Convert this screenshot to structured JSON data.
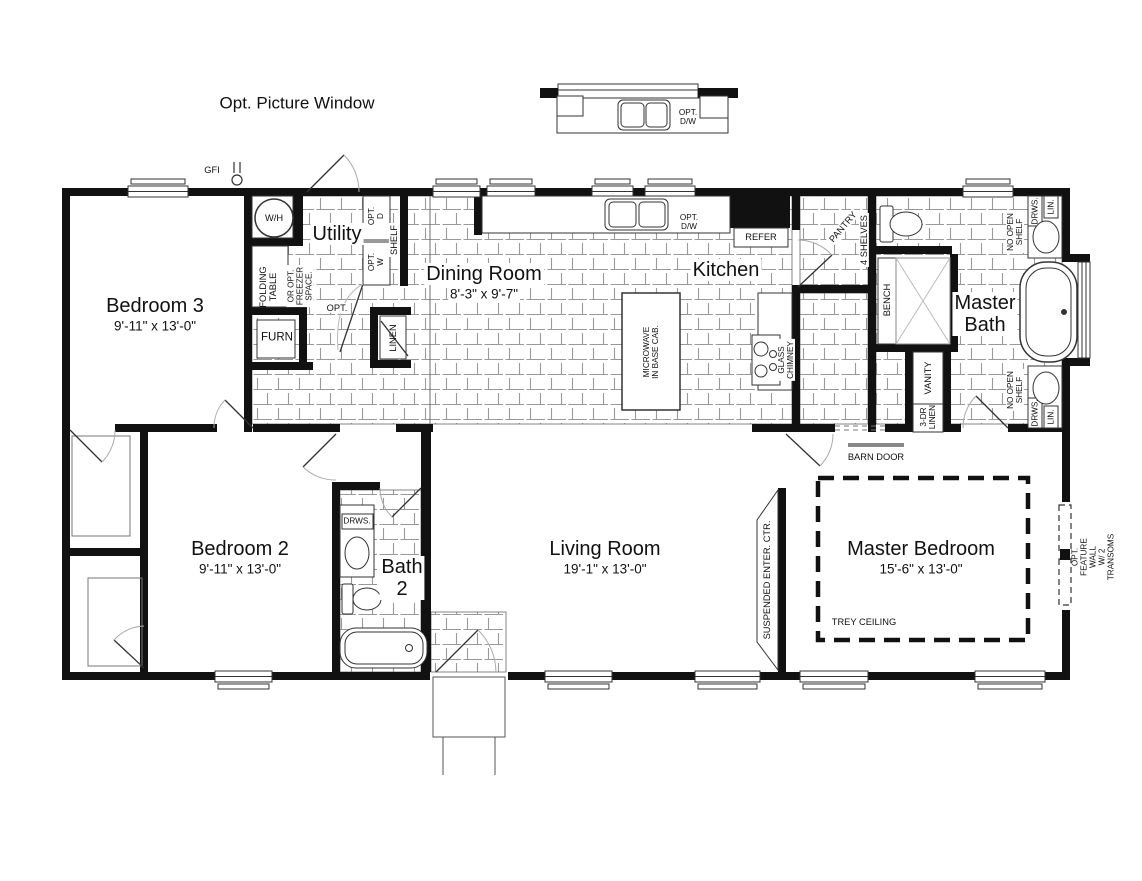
{
  "annotations": {
    "opt_picture_window": "Opt. Picture Window",
    "gfi": "GFI",
    "opt": "OPT.",
    "barn_door": "BARN DOOR",
    "trey_ceiling": "TREY CEILING",
    "suspended_enter_ctr": "SUSPENDED ENTER. CTR.",
    "opt_feature_wall": "OPT. FEATURE WALL\nW/ 2 TRANSOMS"
  },
  "rooms": {
    "bedroom3": {
      "name": "Bedroom 3",
      "dims": "9'-11\" x 13'-0\""
    },
    "utility": {
      "name": "Utility"
    },
    "dining_room": {
      "name": "Dining Room",
      "dims": "8'-3\" x 9'-7\""
    },
    "kitchen": {
      "name": "Kitchen"
    },
    "master_bath": {
      "name": "Master\nBath"
    },
    "bedroom2": {
      "name": "Bedroom 2",
      "dims": "9'-11\" x 13'-0\""
    },
    "bath2": {
      "name": "Bath\n2"
    },
    "living_room": {
      "name": "Living Room",
      "dims": "19'-1\" x 13'-0\""
    },
    "master_bedroom": {
      "name": "Master Bedroom",
      "dims": "15'-6\" x 13'-0\""
    }
  },
  "fixtures": {
    "wh": "W/H",
    "folding_table": "FOLDING\nTABLE",
    "freezer": "OR OPT.\nFREEZER\nSPACE.",
    "opt_dryer": "OPT.\nD",
    "opt_washer": "OPT.\nW",
    "shelf": "SHELF",
    "furn": "FURN",
    "linen": "LINEN",
    "opt_dw": "OPT.\nD/W",
    "refer": "REFER",
    "pantry": "PANTRY",
    "four_shelves": "4 SHELVES",
    "microwave": "MICROWAVE\nIN BASE CAB.",
    "glass_chimney": "GLASS\nCHIMNEY",
    "bench": "BENCH",
    "no_open_shelf": "NO OPEN\nSHELF",
    "drws": "DRWS.",
    "lin": "LIN.",
    "vanity": "VANITY",
    "three_dr_linen": "3-DR\nLINEN"
  }
}
